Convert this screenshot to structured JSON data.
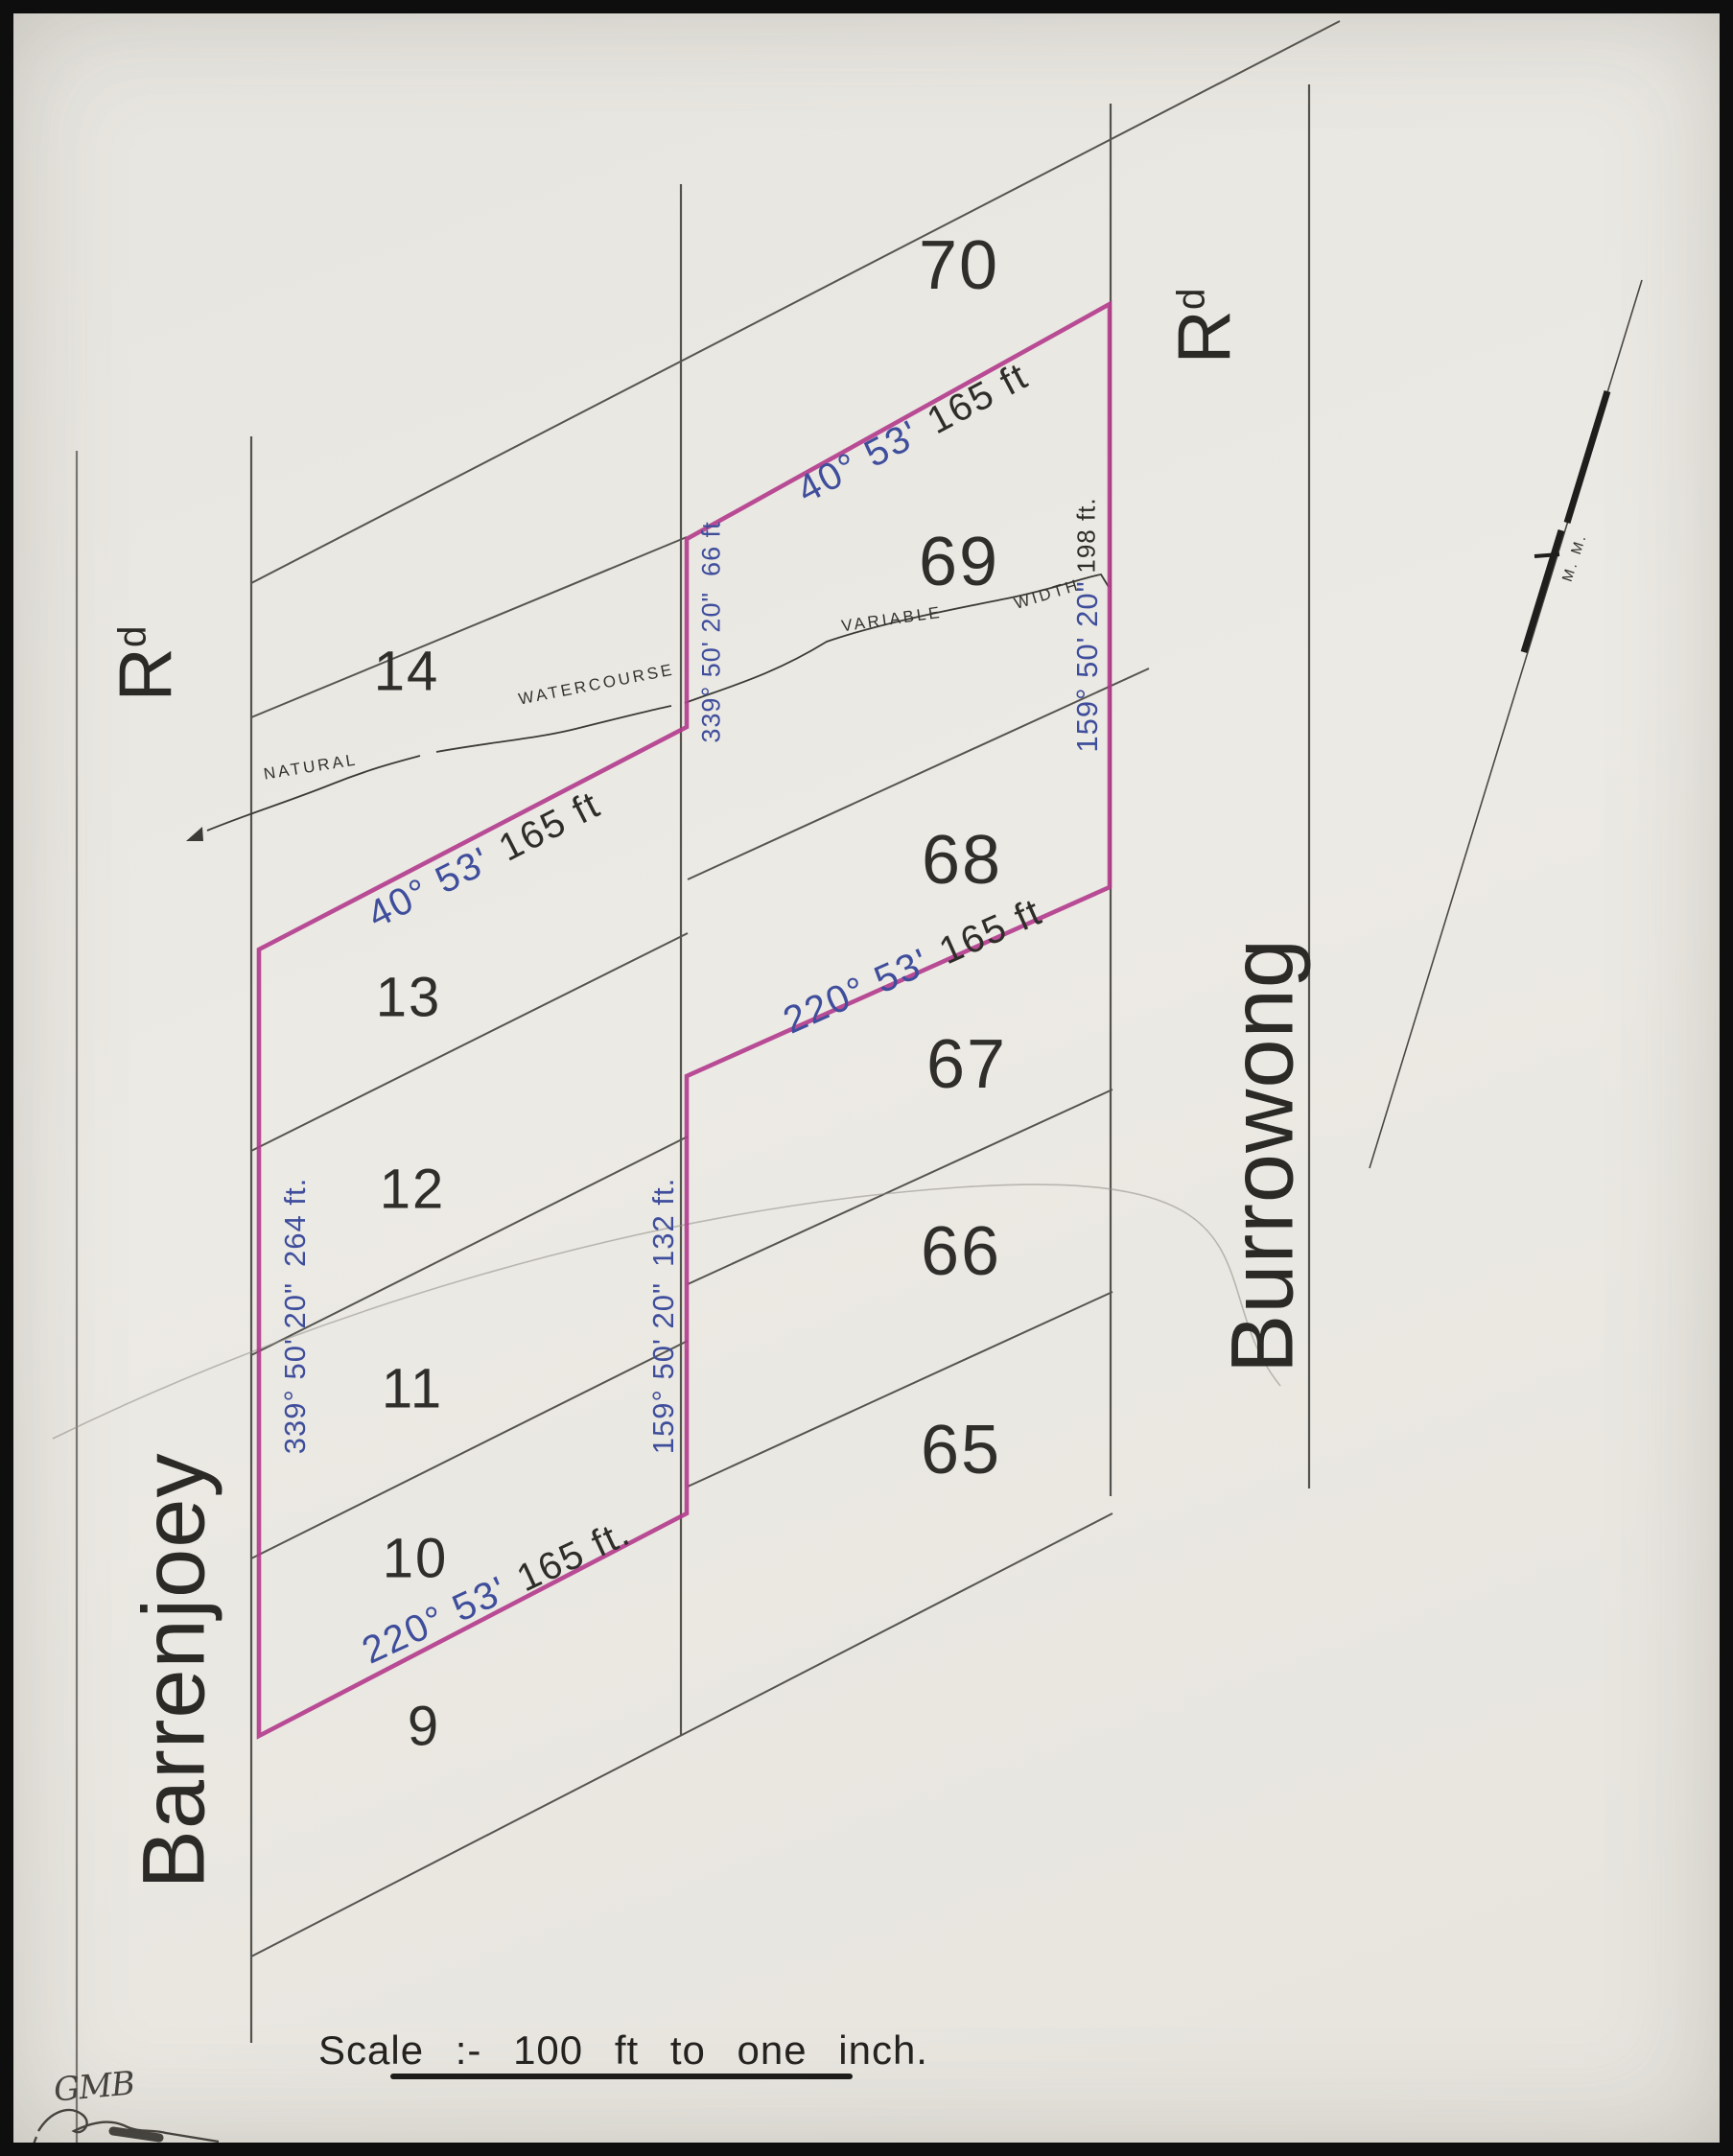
{
  "plan": {
    "scale_text": "Scale :- 100 ft to one inch.",
    "initials": "GMB",
    "north_label": "M. M."
  },
  "roads": {
    "left": {
      "name": "Barrenjoey",
      "abbr_main": "R",
      "abbr_sup": "d"
    },
    "right": {
      "name": "Burrowong",
      "abbr_main": "R",
      "abbr_sup": "d"
    }
  },
  "lots": {
    "left_column": [
      "14",
      "13",
      "12",
      "11",
      "10",
      "9"
    ],
    "right_column": [
      "70",
      "69",
      "68",
      "67",
      "66",
      "65"
    ]
  },
  "watercourse": {
    "natural": "NATURAL",
    "watercourse": "WATERCOURSE",
    "variable": "VARIABLE",
    "width": "WIDTH",
    "width_value": "198 ft."
  },
  "bearings": {
    "top_ne": {
      "bearing": "40° 53'",
      "distance": "165 ft"
    },
    "mid_ne": {
      "bearing": "40° 53'",
      "distance": "165 ft"
    },
    "upper_sw": {
      "bearing": "220° 53'",
      "distance": "165 ft"
    },
    "lower_sw": {
      "bearing": "220° 53'",
      "distance": "165 ft."
    },
    "left_frontage": {
      "bearing": "339° 50' 20\"",
      "distance": "264 ft."
    },
    "notch": {
      "bearing": "339° 50' 20\"",
      "distance": "66 ft"
    },
    "mid_rear": {
      "bearing": "159° 50' 20\"",
      "distance": "132 ft."
    },
    "right_frontage": {
      "bearing": "159° 50' 20\""
    }
  },
  "colors": {
    "parcel_outline": "#b23a8c",
    "bearing_text": "#3f4e9c",
    "ink": "#4b4945",
    "paper": "#e9e7e1"
  }
}
